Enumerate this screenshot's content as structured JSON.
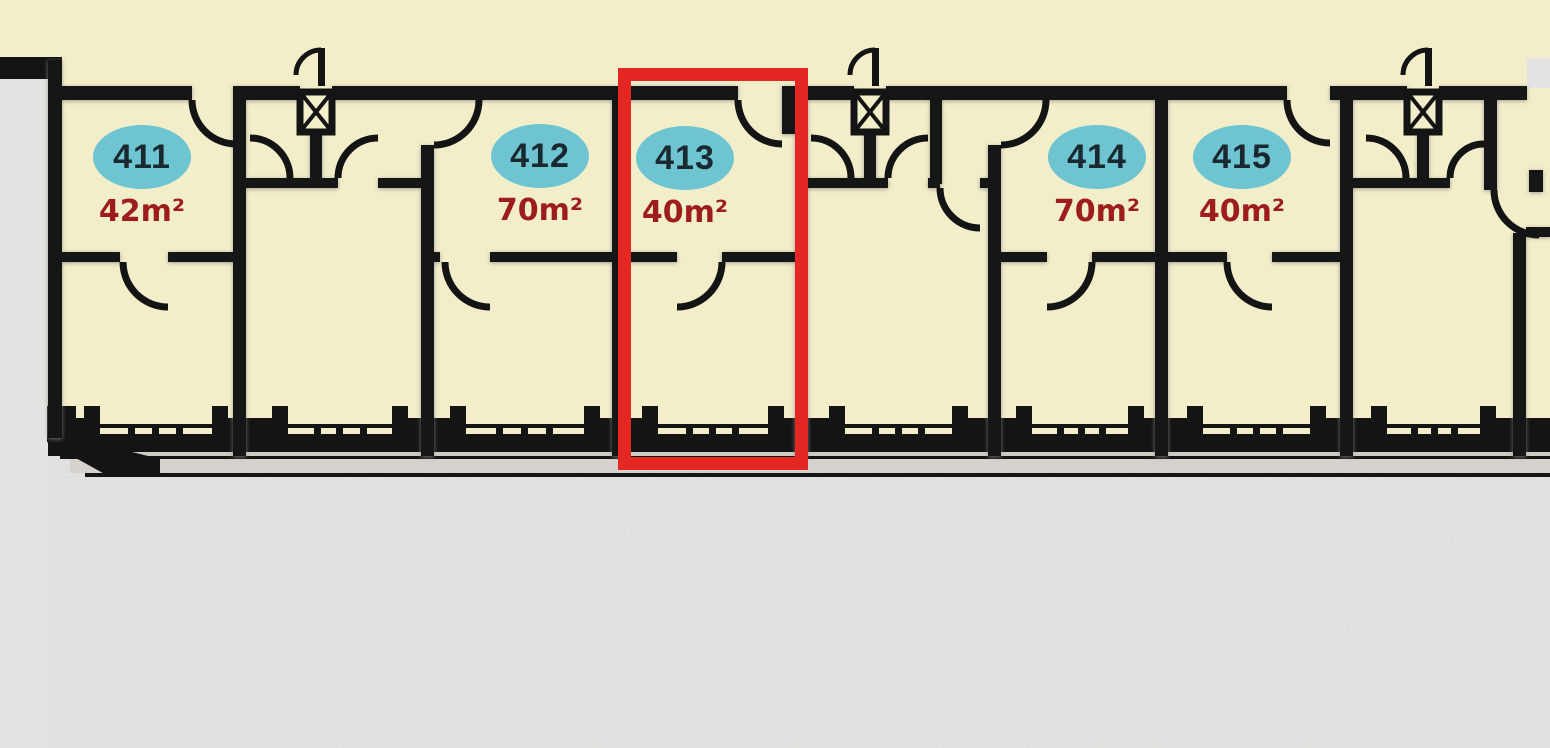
{
  "plan": {
    "units": [
      {
        "number": "411",
        "area": "42m²",
        "highlighted": false
      },
      {
        "number": "412",
        "area": "70m²",
        "highlighted": false
      },
      {
        "number": "413",
        "area": "40m²",
        "highlighted": true
      },
      {
        "number": "414",
        "area": "70m²",
        "highlighted": false
      },
      {
        "number": "415",
        "area": "40m²",
        "highlighted": false
      }
    ],
    "selection": {
      "selected_unit": "413",
      "highlight_color": "#e52724"
    },
    "colors": {
      "background": "#e4e3e1",
      "room_fill": "#f2eeca",
      "wall": "#141414",
      "badge_fill": "#6ec5d1",
      "badge_text": "#1a2930",
      "area_text": "#9d1d1d",
      "balcony_ledge": "#d5d2cd"
    },
    "icons": [
      "shaft-icon",
      "door-arc",
      "window"
    ]
  }
}
